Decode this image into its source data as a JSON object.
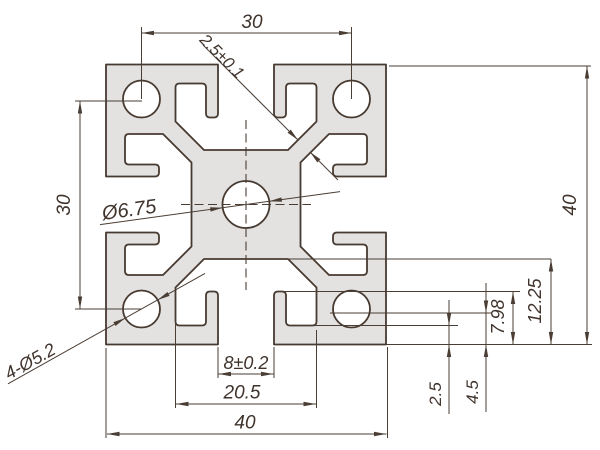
{
  "drawing": {
    "subject": "4040 T-slot aluminum extrusion profile cross-section",
    "colors": {
      "line": "#473a31",
      "dim_line": "#4a3d34",
      "profile_fill": "#e3e2e1",
      "background": "#ffffff"
    },
    "dimensions": {
      "top_hole_spacing": "30",
      "left_hole_spacing": "30",
      "web_thickness": "2.5±0.1",
      "center_bore": "Ø6.75",
      "corner_holes": "4-Ø5.2",
      "slot_opening": "8±0.2",
      "slot_inner_width": "20.5",
      "overall_width": "40",
      "overall_height": "40",
      "lip_depth": "2.5",
      "hook_depth": "4.5",
      "slot_depth": "7.98",
      "cavity_depth": "12.25"
    }
  }
}
